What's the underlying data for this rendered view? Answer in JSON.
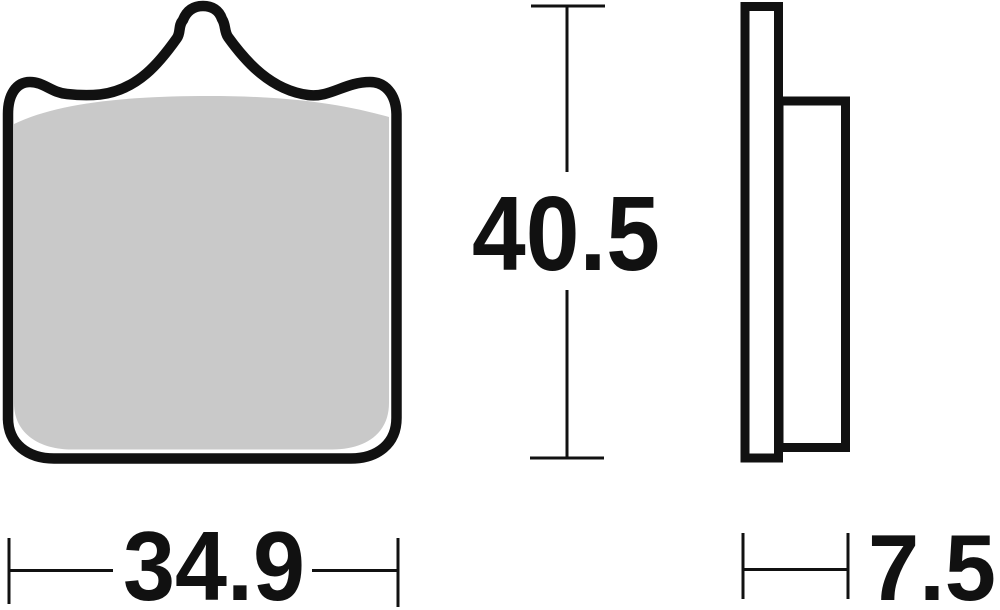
{
  "dimensions": {
    "width": "34.9",
    "height": "40.5",
    "thickness": "7.5"
  },
  "colors": {
    "ink": "#111111",
    "pad_material": "#c9c9c9",
    "backing_plate": "#ffffff",
    "background": "#ffffff"
  }
}
